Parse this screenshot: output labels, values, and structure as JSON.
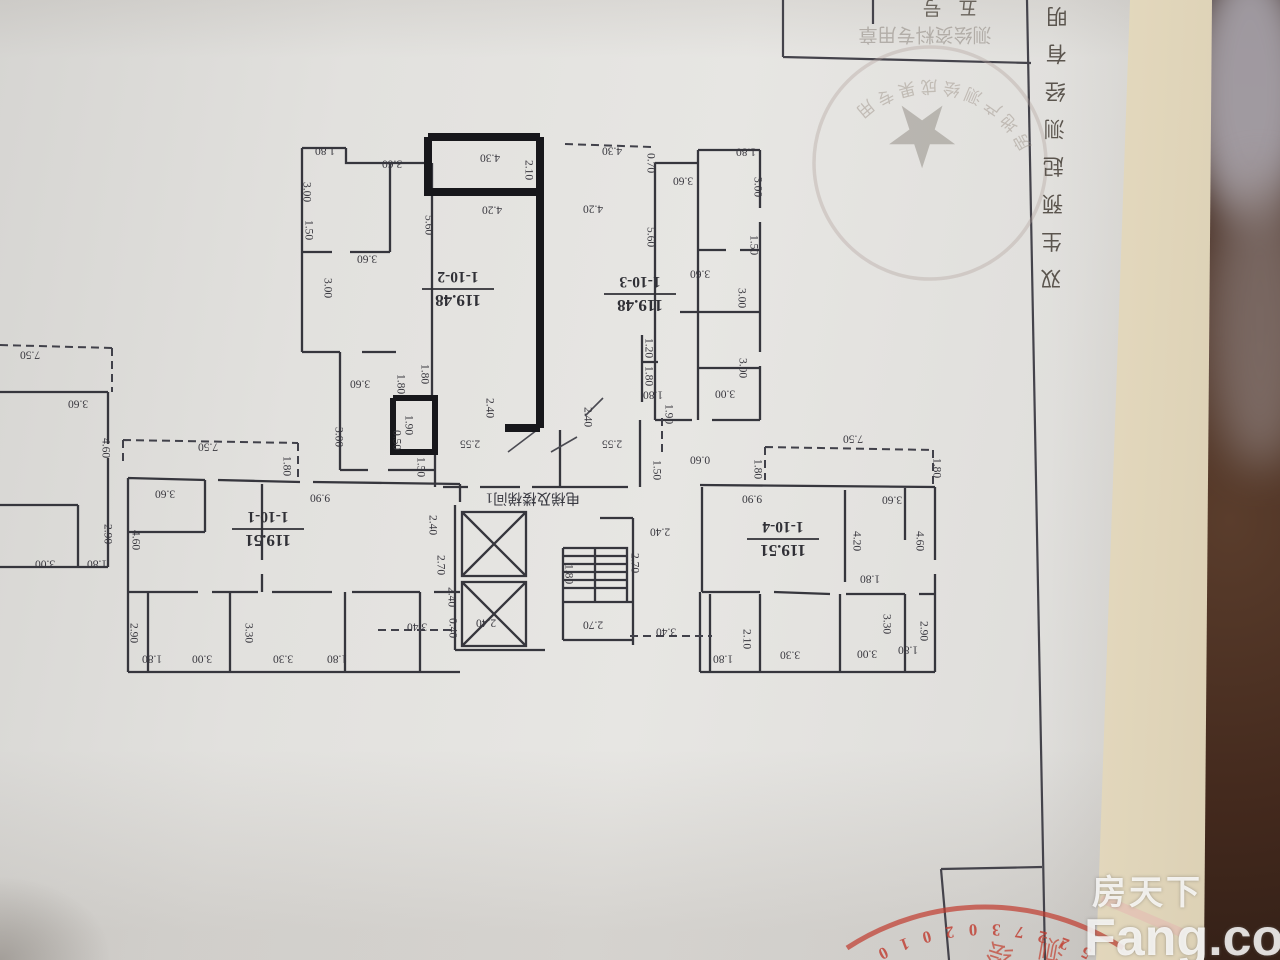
{
  "colors": {
    "stamp_red": "#c03a2e",
    "ink": "#36363d",
    "paper": "#e2e1de",
    "under_page": "#efe6cd",
    "background": "#30201a"
  },
  "watermark": {
    "cn": "房天下",
    "en": "Fang.com"
  },
  "frame": {
    "side_chars": [
      "明",
      "有",
      "经",
      "测",
      "起",
      "预",
      "生",
      "双"
    ],
    "top_cut_chars": [
      "号",
      "五"
    ]
  },
  "stamps": {
    "top": {
      "row_text": "测绘资料专用章",
      "arc_text": "房地产测绘成果专用",
      "star": "★"
    },
    "bottom": {
      "digits": "5227302010",
      "inner_chars": [
        "测",
        "绘"
      ]
    }
  },
  "plan": {
    "core_label": "电梯及楼梯间1",
    "units": [
      {
        "id": "1-10-2",
        "area": "119.48",
        "x": 458,
        "y": 290
      },
      {
        "id": "1-10-3",
        "area": "119.48",
        "x": 640,
        "y": 295
      },
      {
        "id": "1-10-1",
        "area": "119.51",
        "x": 268,
        "y": 530
      },
      {
        "id": "1-10-4",
        "area": "119.51",
        "x": 783,
        "y": 540
      }
    ],
    "dims": [
      [
        "1.80",
        325,
        150,
        "h"
      ],
      [
        "3.00",
        306,
        192,
        "v"
      ],
      [
        "3.60",
        392,
        163,
        "h"
      ],
      [
        "1.50",
        308,
        230,
        "v"
      ],
      [
        "3.60",
        367,
        258,
        "h"
      ],
      [
        "3.00",
        327,
        288,
        "v"
      ],
      [
        "3.60",
        360,
        383,
        "h"
      ],
      [
        "3.00",
        338,
        437,
        "v"
      ],
      [
        "4.30",
        490,
        157,
        "h"
      ],
      [
        "2.10",
        528,
        170,
        "v"
      ],
      [
        "4.20",
        492,
        209,
        "h"
      ],
      [
        "5.60",
        428,
        225,
        "v"
      ],
      [
        "1.80",
        424,
        374,
        "v"
      ],
      [
        "1.80",
        400,
        384,
        "v"
      ],
      [
        "1.90",
        408,
        425,
        "v"
      ],
      [
        "0.50",
        396,
        440,
        "v"
      ],
      [
        "1.50",
        420,
        467,
        "v"
      ],
      [
        "2.40",
        489,
        408,
        "v"
      ],
      [
        "2.55",
        470,
        443,
        "h"
      ],
      [
        "2.40",
        587,
        417,
        "v"
      ],
      [
        "2.55",
        612,
        443,
        "h"
      ],
      [
        "1.90",
        668,
        414,
        "v"
      ],
      [
        "1.50",
        656,
        470,
        "v"
      ],
      [
        "0.60",
        700,
        459,
        "h"
      ],
      [
        "1.80",
        653,
        394,
        "h"
      ],
      [
        "4.30",
        612,
        150,
        "h"
      ],
      [
        "0.70",
        650,
        163,
        "v"
      ],
      [
        "3.60",
        683,
        180,
        "h"
      ],
      [
        "4.20",
        593,
        208,
        "h"
      ],
      [
        "5.60",
        650,
        237,
        "v"
      ],
      [
        "1.80",
        746,
        151,
        "h"
      ],
      [
        "3.00",
        757,
        187,
        "v"
      ],
      [
        "1.50",
        753,
        245,
        "v"
      ],
      [
        "3.60",
        700,
        273,
        "h"
      ],
      [
        "3.00",
        741,
        298,
        "v"
      ],
      [
        "3.00",
        742,
        368,
        "v"
      ],
      [
        "3.00",
        725,
        393,
        "h"
      ],
      [
        "1.20",
        648,
        348,
        "v"
      ],
      [
        "1.80",
        648,
        376,
        "v"
      ],
      [
        "7.50",
        208,
        446,
        "h"
      ],
      [
        "1.80",
        286,
        466,
        "v"
      ],
      [
        "9.90",
        320,
        497,
        "h"
      ],
      [
        "3.60",
        165,
        493,
        "h"
      ],
      [
        "4.60",
        135,
        540,
        "v"
      ],
      [
        "2.90",
        133,
        633,
        "v"
      ],
      [
        "1.80",
        152,
        658,
        "h"
      ],
      [
        "3.00",
        202,
        658,
        "h"
      ],
      [
        "3.30",
        248,
        633,
        "v"
      ],
      [
        "3.30",
        283,
        658,
        "h"
      ],
      [
        "1.80",
        337,
        658,
        "h"
      ],
      [
        "3.40",
        417,
        626,
        "h"
      ],
      [
        "2.40",
        432,
        525,
        "v"
      ],
      [
        "2.70",
        440,
        565,
        "v"
      ],
      [
        "2.40",
        451,
        597,
        "v"
      ],
      [
        "0.40",
        452,
        628,
        "v"
      ],
      [
        "2.40",
        486,
        622,
        "h"
      ],
      [
        "1.80",
        568,
        574,
        "v"
      ],
      [
        "2.70",
        593,
        624,
        "h"
      ],
      [
        "2.40",
        660,
        531,
        "h"
      ],
      [
        "2.70",
        634,
        563,
        "v"
      ],
      [
        "3.40",
        666,
        631,
        "h"
      ],
      [
        "7.50",
        853,
        438,
        "h"
      ],
      [
        "1.80",
        757,
        469,
        "v"
      ],
      [
        "1.80",
        936,
        468,
        "v"
      ],
      [
        "9.90",
        752,
        498,
        "h"
      ],
      [
        "3.60",
        892,
        499,
        "h"
      ],
      [
        "4.20",
        856,
        541,
        "v"
      ],
      [
        "4.60",
        919,
        541,
        "v"
      ],
      [
        "1.80",
        870,
        578,
        "h"
      ],
      [
        "3.30",
        886,
        624,
        "v"
      ],
      [
        "2.90",
        923,
        631,
        "v"
      ],
      [
        "1.80",
        908,
        649,
        "h"
      ],
      [
        "2.10",
        746,
        639,
        "v"
      ],
      [
        "3.30",
        790,
        654,
        "h"
      ],
      [
        "3.00",
        867,
        653,
        "h"
      ],
      [
        "1.80",
        723,
        658,
        "h"
      ],
      [
        "7.50",
        30,
        354,
        "h"
      ],
      [
        "3.60",
        78,
        403,
        "h"
      ],
      [
        "4.60",
        105,
        448,
        "v"
      ],
      [
        "2.90",
        107,
        534,
        "v"
      ],
      [
        "1.80",
        97,
        563,
        "h"
      ],
      [
        "3.00",
        45,
        563,
        "h"
      ]
    ]
  }
}
